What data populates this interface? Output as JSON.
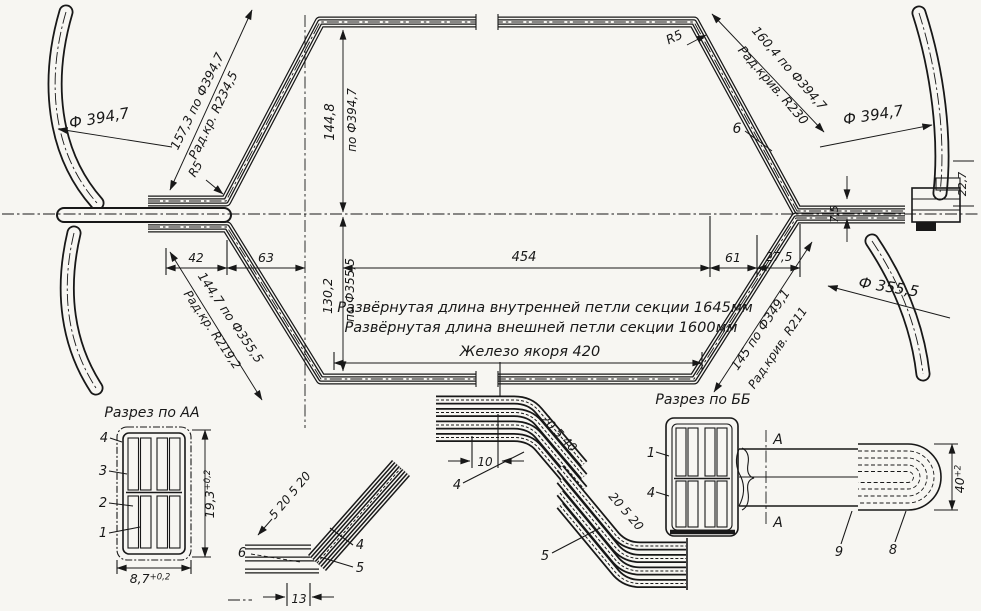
{
  "colors": {
    "ink": "#181818",
    "paper": "#f7f6f2"
  },
  "main": {
    "dia_left": "Ф 394,7",
    "slant_lt": "157,3 по Ф394,7",
    "slant_lt_rad": "Рад.кр. R234,5",
    "r5_left": "R5",
    "h_top": "144,8",
    "h_top_ref": "по Ф394,7",
    "r5_right": "R5",
    "slant_rt": "160,4 по Ф394,7",
    "slant_rt_rad": "Рад.крив. R230",
    "callout6": "6",
    "dia_right": "Ф 394,7",
    "off_22_7": "22,7",
    "off_7_5": "7,5",
    "w42": "42",
    "w63": "63",
    "w454": "454",
    "w61": "61",
    "w27_5": "27,5",
    "h_bot": "130,2",
    "h_bot_ref": "по Ф355,5",
    "slant_lb": "144,7 по Ф355,5",
    "slant_lb_rad": "Рад.кр. R219,2",
    "dia_right_bot": "Ф 355,5",
    "slant_rb": "145 по Ф349,1",
    "slant_rb_rad": "Рад.крив. R211",
    "note_inner": "Развёрнутая длина внутренней петли секции 1645мм",
    "note_outer": "Развёрнутая длина  внешней петли секции 1600мм",
    "note_iron": "Железо якоря  420"
  },
  "section_aa": {
    "title": "Разрез по АА",
    "c4": "4",
    "c3": "3",
    "c2": "2",
    "c1": "1",
    "h": "19,3",
    "h_tol": "+0,2",
    "w": "8,7",
    "w_tol": "+0,2"
  },
  "detail_bend": {
    "c6": "6",
    "c4": "4",
    "c5": "5",
    "seq": "5 20 5 20",
    "d13": "13"
  },
  "detail_z": {
    "d10": "10",
    "top": "20 5 40",
    "bot": "20 5 20",
    "c4": "4",
    "c5": "5"
  },
  "section_bb": {
    "title": "Разрез по ББ",
    "c1": "1",
    "c4": "4"
  },
  "detail_loop": {
    "a_top": "A",
    "a_bot": "A",
    "c9": "9",
    "c8": "8",
    "d40": "40",
    "d40_tol": "+2"
  }
}
